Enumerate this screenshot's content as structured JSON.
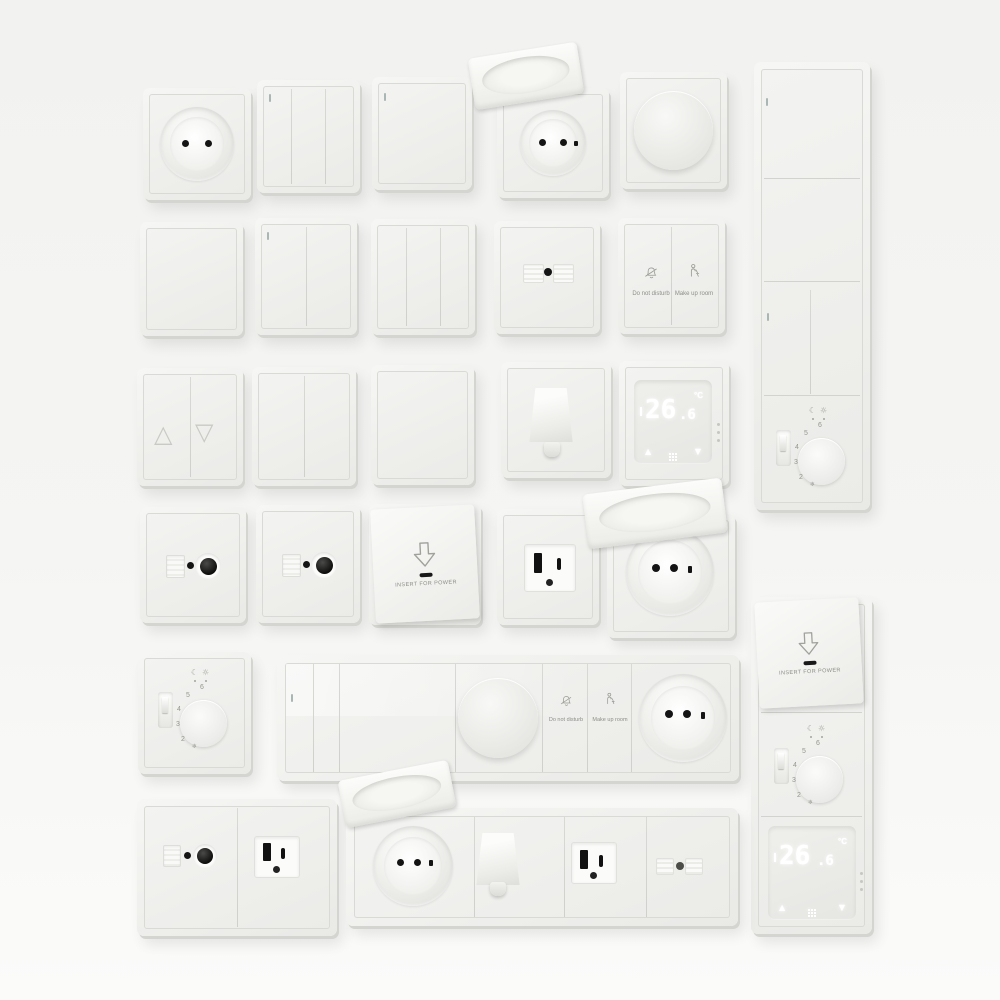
{
  "scene": {
    "title": "White electrical wall plates collection — switches, sockets, dimmers, thermostats",
    "background_color": "#f4f4f2",
    "plate_color": "#efefec",
    "detail_dark": "#141414"
  },
  "icons": {
    "moon": "☾",
    "sun": "☼",
    "frost": "❄",
    "triangle_up": "△",
    "triangle_down": "▽",
    "arrow_up": "▲",
    "arrow_down": "▼"
  },
  "hotel_panel": {
    "do_not_disturb": "Do not disturb",
    "make_up_room": "Make up room"
  },
  "keycard": {
    "label": "INSERT FOR POWER"
  },
  "thermostat_digital": {
    "integer": "26",
    "decimal": ".6",
    "unit": "°C"
  },
  "thermostat_dial": {
    "scale": [
      "2",
      "3",
      "4",
      "5",
      "6"
    ]
  }
}
